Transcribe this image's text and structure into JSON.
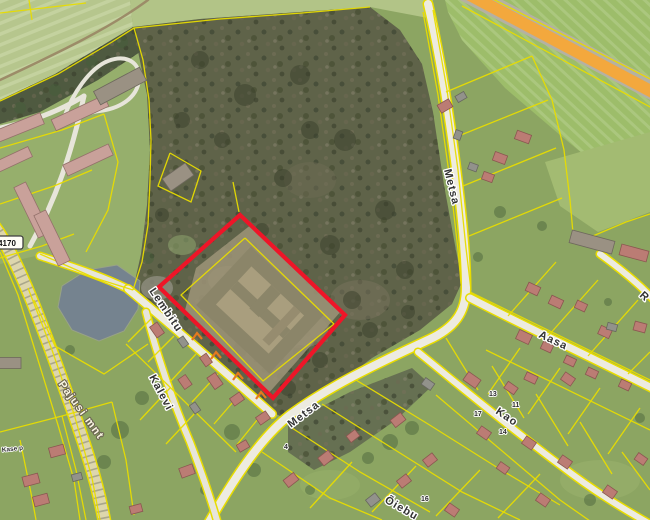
{
  "map": {
    "width": 650,
    "height": 520,
    "base": "#8ca562",
    "zones": [
      {
        "name": "zone-field-top-left",
        "pts": "0,0 130,0 133,27 108,44 55,76 0,102",
        "fill": "#b6c68d",
        "pat": "stripes2"
      },
      {
        "name": "zone-field-top-strip",
        "pts": "130,0 433,0 428,18 370,7 300,12 200,19 133,27",
        "fill": "#b2c487"
      },
      {
        "name": "zone-field-top-right",
        "pts": "445,0 650,0 650,195 600,168 560,135 505,88 462,40 448,12",
        "fill": "#9dbd6a",
        "pat": "stripes"
      },
      {
        "name": "zone-apartment-grounds",
        "pts": "0,102 55,76 108,44 133,27 146,80 151,140 149,200 143,252 133,290 95,278 40,255 0,264",
        "fill": "#96af6c"
      },
      {
        "name": "zone-forest",
        "pts": "133,27 200,19 300,12 370,7 400,30 422,64 433,112 444,185 455,245 462,282 452,304 420,330 372,358 322,396 288,420 272,412 200,352 133,290 141,254 147,205 150,150 147,95",
        "fill": "#5f6349",
        "pat": "speck"
      },
      {
        "name": "zone-tree-row-top-left",
        "pts": "0,100 55,74 108,42 133,27 140,52 98,80 40,112 0,124",
        "fill": "#4f5a40",
        "pat": "speck"
      },
      {
        "name": "zone-scrub-south",
        "pts": "288,424 350,392 412,368 432,386 396,420 350,452 314,470 288,452",
        "fill": "#667052",
        "pat": "speck"
      },
      {
        "name": "zone-lawn-right",
        "pts": "545,162 650,132 650,212 598,232 560,206",
        "fill": "#a3bb72"
      }
    ],
    "patches": [
      [
        300,
        330,
        28,
        18,
        "#8f8870",
        0.55
      ],
      [
        228,
        280,
        20,
        14,
        "#a39a7c",
        0.6
      ],
      [
        157,
        288,
        16,
        12,
        "#8e8d7f",
        0.8
      ],
      [
        182,
        245,
        14,
        10,
        "#8aa06a",
        0.6
      ],
      [
        360,
        300,
        30,
        20,
        "#79745e",
        0.5
      ],
      [
        310,
        180,
        26,
        18,
        "#6e6b54",
        0.5
      ],
      [
        600,
        480,
        40,
        20,
        "#9cb46d",
        0.5
      ],
      [
        330,
        485,
        30,
        15,
        "#9cb46d",
        0.4
      ]
    ],
    "water": {
      "name": "pond",
      "pts": "62,286 87,270 117,265 140,281 138,309 124,331 99,341 72,330 58,307",
      "fill": "#75838f",
      "stroke": "#98a287"
    },
    "trees": [
      [
        200,
        60,
        9,
        "f"
      ],
      [
        245,
        95,
        11,
        "f"
      ],
      [
        300,
        75,
        10,
        "f"
      ],
      [
        345,
        140,
        11,
        "f"
      ],
      [
        385,
        210,
        10,
        "f"
      ],
      [
        405,
        270,
        9,
        "f"
      ],
      [
        330,
        245,
        10,
        "f"
      ],
      [
        283,
        178,
        9,
        "f"
      ],
      [
        182,
        120,
        8,
        "f"
      ],
      [
        162,
        215,
        7,
        "f"
      ],
      [
        222,
        140,
        8,
        "f"
      ],
      [
        352,
        300,
        9,
        "f"
      ],
      [
        300,
        320,
        8,
        "f"
      ],
      [
        262,
        230,
        7,
        "f"
      ],
      [
        310,
        130,
        9,
        "f"
      ],
      [
        370,
        330,
        8,
        "f"
      ],
      [
        408,
        312,
        7,
        "f"
      ],
      [
        288,
        388,
        8,
        "f"
      ],
      [
        240,
        350,
        7,
        "f"
      ],
      [
        320,
        360,
        8,
        "f"
      ],
      [
        300,
        352,
        7,
        "f"
      ],
      [
        270,
        368,
        6,
        "f"
      ],
      [
        20,
        108,
        6,
        "g"
      ],
      [
        55,
        90,
        6,
        "g"
      ],
      [
        92,
        62,
        6,
        "g"
      ],
      [
        122,
        42,
        6,
        "g"
      ],
      [
        70,
        350,
        5,
        "g"
      ],
      [
        148,
        258,
        6,
        "g"
      ],
      [
        120,
        430,
        9,
        "g"
      ],
      [
        104,
        462,
        7,
        "g"
      ],
      [
        142,
        398,
        7,
        "g"
      ],
      [
        232,
        432,
        8,
        "g"
      ],
      [
        254,
        470,
        7,
        "g"
      ],
      [
        390,
        442,
        8,
        "g"
      ],
      [
        368,
        458,
        6,
        "g"
      ],
      [
        412,
        428,
        7,
        "g"
      ],
      [
        500,
        212,
        6,
        "g"
      ],
      [
        542,
        226,
        5,
        "g"
      ],
      [
        478,
        257,
        5,
        "g"
      ],
      [
        608,
        302,
        4,
        "g"
      ],
      [
        640,
        418,
        5,
        "g"
      ],
      [
        590,
        500,
        6,
        "g"
      ],
      [
        310,
        490,
        5,
        "g"
      ],
      [
        205,
        490,
        5,
        "g"
      ]
    ],
    "complex": {
      "name": "plot-building-complex",
      "cx": 260,
      "cy": 310,
      "rot": 43,
      "apron": "196,268 252,224 342,310 268,394 184,314",
      "apronFill": "#9a9176",
      "parts": [
        [
          -50,
          -40,
          100,
          80,
          "#8b8569"
        ],
        [
          -36,
          -26,
          72,
          52,
          "#a99e7e"
        ],
        [
          -36,
          -6,
          72,
          11,
          "#8b8569"
        ],
        [
          -9,
          -26,
          13,
          32,
          "#8b8569"
        ],
        [
          22,
          -26,
          9,
          46,
          "#968c6f"
        ]
      ]
    },
    "roads": [
      {
        "name": "highway-asphalt",
        "d": "M 466,-8 L 660,94",
        "w": 20,
        "fill": "#b5b1a2"
      },
      {
        "name": "highway-orange-overlay",
        "d": "M 468,-6 L 660,96",
        "w": 12,
        "fill": "#f3a83d"
      },
      {
        "name": "dirt-track-top-left",
        "d": "M 148,0 C 110,28 60,52 0,80",
        "w": 2.5,
        "fill": "#9c8c68"
      },
      {
        "name": "apartment-road-horizontal",
        "d": "M 0,128 C 30,122 58,112 84,96",
        "w": 5,
        "fill": "#e7e5da"
      },
      {
        "name": "apartment-road-vertical",
        "d": "M 84,96 C 72,152 56,200 30,246",
        "w": 5,
        "fill": "#e7e5da"
      },
      {
        "name": "barn-loop-road",
        "d": "M 64,118 C 72,94 90,68 108,61 C 126,54 141,62 139,80 C 137,99 118,109 99,111 C 83,113 70,121 64,118",
        "w": 4,
        "fill": "#e7e5da"
      },
      {
        "name": "pajusi-mnt-road",
        "d": "M -6,226 C 18,258 44,330 69,400 C 84,442 97,480 105,524",
        "w": 11,
        "fill": "#ddd6ad",
        "edge": "#e8dc00",
        "dash": "1.6,5.5",
        "dashColor": "#77776a"
      },
      {
        "name": "metsa-road",
        "d": "M 208,524 C 232,482 260,438 290,415 C 335,382 390,358 428,340 C 455,328 466,312 466,288 C 466,230 448,90 428,4",
        "w": 8,
        "fill": "#edebe0",
        "edge": "#e8dc00"
      },
      {
        "name": "aasa-road",
        "d": "M 470,298 C 520,324 580,352 652,388",
        "w": 7,
        "fill": "#edebe0",
        "edge": "#e8dc00"
      },
      {
        "name": "kao-road",
        "d": "M 418,352 C 455,382 505,424 560,465 C 595,492 622,508 650,524",
        "w": 6,
        "fill": "#edebe0",
        "edge": "#e8dc00"
      },
      {
        "name": "lembitu-road-west",
        "d": "M 40,256 C 70,266 102,276 128,289",
        "w": 6,
        "fill": "#e7e5da",
        "edge": "#e8dc00"
      },
      {
        "name": "lembitu-road",
        "d": "M 128,289 C 165,320 225,372 272,414",
        "w": 7,
        "fill": "#edebe0",
        "edge": "#e8dc00"
      },
      {
        "name": "kalevi-road",
        "d": "M 146,312 C 156,352 172,400 190,442 C 200,468 210,496 218,524",
        "w": 6,
        "fill": "#e7e5da",
        "edge": "#e8dc00"
      },
      {
        "name": "road-stub-right",
        "d": "M 600,254 C 622,270 640,285 654,300",
        "w": 6,
        "fill": "#edebe0",
        "edge": "#e8dc00"
      }
    ],
    "parcels": [
      "0,13 86,3",
      "29,0 32,20",
      "0,101 58,74 112,42 134,28 220,19 302,13 370,7",
      "134,28 143,60 149,100 151,140 150,180 148,225 142,262 133,290",
      "462,6 652,108",
      "479,-8 664,86",
      "433,10 447,90 458,170 466,248 471,290",
      "423,12 438,95 450,180 458,250 461,284",
      "170,153 201,171 191,202 158,186 170,153",
      "245,238 334,324 263,381 181,295 245,238",
      "446,92 532,56",
      "456,137 548,100",
      "463,186 556,148",
      "469,236 562,198",
      "532,56 552,100 564,150 570,200 574,244",
      "574,244 626,222 650,214",
      "470,292 650,380",
      "508,316 556,262",
      "548,336 598,280",
      "588,356 638,300",
      "628,374 650,352",
      "520,348 488,394",
      "560,368 528,414",
      "600,388 568,434",
      "640,408 608,454",
      "486,350 650,430",
      "446,338 478,390",
      "492,366 524,418",
      "536,394 568,446",
      "580,422 612,474",
      "622,452 650,490",
      "436,395 560,500 600,528",
      "262,452 330,498 382,520",
      "292,428 360,472 430,512",
      "322,404 392,448 462,492 520,520",
      "356,380 428,424 498,468 560,505",
      "310,508 352,462",
      "372,512 416,466",
      "436,516 480,470",
      "498,518 540,474",
      "152,318 128,342",
      "174,336 148,362",
      "196,354 170,382",
      "218,374 192,402",
      "240,394 214,424",
      "262,414 236,446",
      "126,344 236,452",
      "170,388 140,420",
      "196,412 166,444",
      "34,300 55,346 104,374 148,344",
      "28,288 52,350 74,414 92,478 100,520",
      "0,252 18,295 38,360 58,425 74,480 80,520",
      "0,432 62,416 112,402",
      "62,416 76,470 86,520",
      "20,440 32,498 36,520",
      "112,402 126,460 134,515",
      "0,148 62,130 104,114",
      "0,204 54,186 92,170",
      "0,258 42,246 74,234",
      "104,114 118,162 108,210 86,252",
      "239,212 233,182",
      "40,254 95,278 133,290"
    ],
    "plot": {
      "name": "selected-plot-outline",
      "pts": "240,215 345,315 273,398 159,287",
      "stroke": "#ee1528",
      "w": 4.2
    },
    "bcolors": {
      "P": [
        "#c9a19a",
        "#93706a"
      ],
      "G": [
        "#9a9183",
        "#6e685d"
      ],
      "p": [
        "#bb7c74",
        "#8a5750"
      ],
      "g": [
        "#92928b",
        "#67675f"
      ]
    },
    "buildings": [
      [
        18,
        128,
        52,
        12,
        -22,
        "P"
      ],
      [
        80,
        113,
        58,
        12,
        -25,
        "P"
      ],
      [
        12,
        160,
        40,
        11,
        -25,
        "P"
      ],
      [
        88,
        160,
        50,
        12,
        -25,
        "P"
      ],
      [
        32,
        210,
        56,
        13,
        64,
        "P"
      ],
      [
        52,
        238,
        56,
        13,
        64,
        "P"
      ],
      [
        120,
        86,
        52,
        15,
        -28,
        "G"
      ],
      [
        178,
        177,
        28,
        15,
        -35,
        "G"
      ],
      [
        592,
        242,
        44,
        13,
        15,
        "G"
      ],
      [
        10,
        363,
        22,
        11,
        0,
        "G"
      ],
      [
        445,
        106,
        13,
        9,
        -30,
        "p"
      ],
      [
        461,
        97,
        10,
        7,
        -30,
        "g"
      ],
      [
        523,
        137,
        15,
        9,
        20,
        "p"
      ],
      [
        500,
        158,
        13,
        9,
        20,
        "p"
      ],
      [
        488,
        177,
        11,
        8,
        20,
        "p"
      ],
      [
        473,
        167,
        9,
        7,
        20,
        "g"
      ],
      [
        458,
        135,
        9,
        7,
        -70,
        "g"
      ],
      [
        533,
        289,
        13,
        9,
        25,
        "p"
      ],
      [
        556,
        302,
        13,
        9,
        25,
        "p"
      ],
      [
        581,
        306,
        11,
        8,
        25,
        "p"
      ],
      [
        605,
        332,
        12,
        9,
        25,
        "p"
      ],
      [
        524,
        337,
        14,
        10,
        25,
        "p"
      ],
      [
        547,
        347,
        11,
        8,
        25,
        "p"
      ],
      [
        570,
        361,
        11,
        8,
        25,
        "p"
      ],
      [
        592,
        373,
        11,
        8,
        25,
        "p"
      ],
      [
        531,
        378,
        12,
        8,
        25,
        "p"
      ],
      [
        625,
        385,
        11,
        8,
        25,
        "p"
      ],
      [
        634,
        253,
        28,
        11,
        15,
        "p"
      ],
      [
        640,
        327,
        12,
        9,
        15,
        "p"
      ],
      [
        612,
        327,
        10,
        7,
        15,
        "g"
      ],
      [
        472,
        380,
        15,
        10,
        35,
        "p"
      ],
      [
        428,
        384,
        11,
        8,
        35,
        "g"
      ],
      [
        511,
        388,
        12,
        8,
        35,
        "p"
      ],
      [
        568,
        379,
        12,
        9,
        35,
        "p"
      ],
      [
        484,
        433,
        12,
        9,
        35,
        "p"
      ],
      [
        529,
        443,
        12,
        9,
        35,
        "p"
      ],
      [
        565,
        462,
        12,
        9,
        35,
        "p"
      ],
      [
        503,
        468,
        11,
        8,
        35,
        "p"
      ],
      [
        610,
        492,
        12,
        9,
        35,
        "p"
      ],
      [
        641,
        459,
        11,
        8,
        35,
        "p"
      ],
      [
        291,
        480,
        13,
        9,
        -38,
        "p"
      ],
      [
        326,
        458,
        13,
        10,
        -38,
        "p"
      ],
      [
        353,
        436,
        11,
        8,
        -38,
        "p"
      ],
      [
        398,
        420,
        13,
        9,
        -38,
        "p"
      ],
      [
        404,
        481,
        12,
        9,
        -38,
        "p"
      ],
      [
        430,
        460,
        12,
        9,
        -38,
        "p"
      ],
      [
        543,
        500,
        12,
        9,
        35,
        "p"
      ],
      [
        452,
        510,
        12,
        9,
        35,
        "p"
      ],
      [
        373,
        500,
        12,
        9,
        -38,
        "g"
      ],
      [
        157,
        330,
        13,
        9,
        55,
        "p"
      ],
      [
        183,
        342,
        10,
        7,
        55,
        "g"
      ],
      [
        206,
        360,
        11,
        8,
        55,
        "p"
      ],
      [
        185,
        382,
        12,
        9,
        55,
        "p"
      ],
      [
        215,
        381,
        14,
        10,
        55,
        "p"
      ],
      [
        237,
        399,
        12,
        9,
        -35,
        "p"
      ],
      [
        263,
        418,
        12,
        9,
        -35,
        "p"
      ],
      [
        195,
        408,
        10,
        7,
        55,
        "g"
      ],
      [
        187,
        471,
        14,
        10,
        -20,
        "p"
      ],
      [
        243,
        446,
        11,
        8,
        -30,
        "p"
      ],
      [
        31,
        480,
        16,
        10,
        -15,
        "p"
      ],
      [
        57,
        451,
        15,
        10,
        -15,
        "p"
      ],
      [
        77,
        477,
        10,
        7,
        -15,
        "g"
      ],
      [
        41,
        500,
        15,
        10,
        -15,
        "p"
      ],
      [
        136,
        509,
        12,
        8,
        -15,
        "p"
      ]
    ],
    "markers": {
      "color": "#e5791e",
      "pts": [
        [
          196,
          337
        ],
        [
          215,
          356
        ],
        [
          237,
          377
        ],
        [
          260,
          396
        ]
      ]
    },
    "labels": [
      {
        "n": "street-label-pajusi-mnt",
        "t": "Pajusi mnt",
        "x": 58,
        "y": 384,
        "r": 54,
        "c": "lblw"
      },
      {
        "n": "street-label-lembitu",
        "t": "Lembitu",
        "x": 149,
        "y": 291,
        "r": 56,
        "c": "lbl"
      },
      {
        "n": "street-label-kalevi",
        "t": "Kalevi",
        "x": 149,
        "y": 377,
        "r": 62,
        "c": "lbl"
      },
      {
        "n": "street-label-metsa-north",
        "t": "Metsa",
        "x": 444,
        "y": 170,
        "r": 76,
        "c": "lbl",
        "fs": 10.5
      },
      {
        "n": "street-label-metsa-south",
        "t": "Metsa",
        "x": 291,
        "y": 428,
        "r": -37,
        "c": "lbl"
      },
      {
        "n": "street-label-aasa",
        "t": "Aasa",
        "x": 538,
        "y": 337,
        "r": 25,
        "c": "lbl"
      },
      {
        "n": "street-label-kao",
        "t": "Kao",
        "x": 495,
        "y": 413,
        "r": 34,
        "c": "lbl"
      },
      {
        "n": "street-label-oiebu-partial",
        "t": "Õiebu",
        "x": 384,
        "y": 502,
        "r": 30,
        "c": "lbl"
      },
      {
        "n": "street-label-r-partial",
        "t": "R",
        "x": 639,
        "y": 296,
        "r": 42,
        "c": "lbl"
      },
      {
        "n": "street-label-kase-p",
        "t": "Kase p",
        "x": 2,
        "y": 452,
        "r": -6,
        "c": "numl"
      },
      {
        "n": "house-number-13",
        "t": "13",
        "x": 489,
        "y": 396,
        "r": 0,
        "c": "num"
      },
      {
        "n": "house-number-11",
        "t": "11",
        "x": 512,
        "y": 407,
        "r": 0,
        "c": "num"
      },
      {
        "n": "house-number-17",
        "t": "17",
        "x": 474,
        "y": 416,
        "r": 0,
        "c": "num"
      },
      {
        "n": "house-number-14",
        "t": "14",
        "x": 499,
        "y": 434,
        "r": 0,
        "c": "num"
      },
      {
        "n": "house-number-16",
        "t": "16",
        "x": 421,
        "y": 501,
        "r": 0,
        "c": "num"
      },
      {
        "n": "house-number-4",
        "t": "4",
        "x": 284,
        "y": 449,
        "r": 0,
        "c": "num"
      }
    ],
    "badge": {
      "name": "road-number-badge",
      "text": "4170",
      "x": -9,
      "y": 236,
      "w": 32,
      "h": 13
    }
  }
}
